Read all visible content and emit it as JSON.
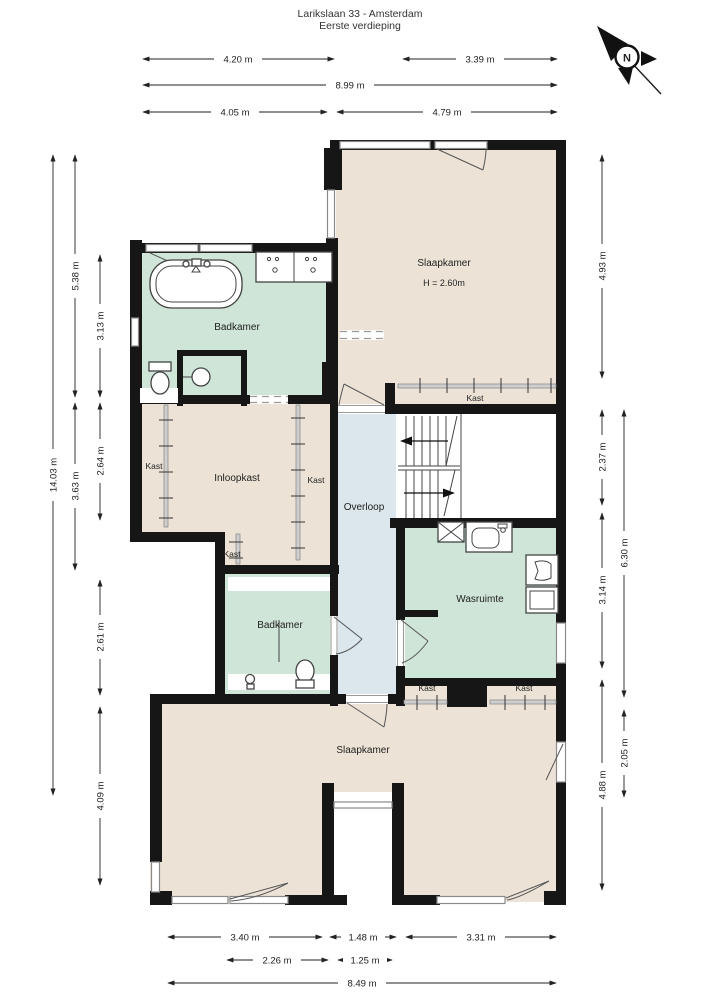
{
  "title": {
    "line1": "Larikslaan 33 - Amsterdam",
    "line2": "Eerste verdieping"
  },
  "compass": {
    "label": "N"
  },
  "rooms": {
    "badkamer_top": {
      "label": "Badkamer"
    },
    "slaapkamer_top": {
      "label": "Slaapkamer",
      "ceiling": "H = 2.60m"
    },
    "kast_slaapkamer": {
      "label": "Kast"
    },
    "kast_left": {
      "label": "Kast"
    },
    "inloopkast": {
      "label": "Inloopkast"
    },
    "kast_mid": {
      "label": "Kast"
    },
    "kast_small": {
      "label": "Kast"
    },
    "overloop": {
      "label": "Overloop"
    },
    "wasruimte": {
      "label": "Wasruimte"
    },
    "badkamer_bottom": {
      "label": "Badkamer"
    },
    "kast_bottom_left": {
      "label": "Kast"
    },
    "kast_bottom_right": {
      "label": "Kast"
    },
    "slaapkamer_bottom": {
      "label": "Slaapkamer"
    }
  },
  "dimensions": {
    "top": {
      "d1": "4.20 m",
      "d2": "3.39 m",
      "d3": "8.99 m",
      "d4": "4.05 m",
      "d5": "4.79 m"
    },
    "left": {
      "d1": "14.03 m",
      "d2": "5.38 m",
      "d3": "3.63 m",
      "d4": "3.13 m",
      "d5": "2.64 m",
      "d6": "2.61 m",
      "d7": "4.09 m"
    },
    "right": {
      "d1": "4.93 m",
      "d2": "2.37 m",
      "d3": "3.14 m",
      "d4": "4.88 m",
      "d5": "6.30 m",
      "d6": "2.05 m"
    },
    "bottom": {
      "d1": "3.40 m",
      "d2": "1.48 m",
      "d3": "3.31 m",
      "d4": "2.26 m",
      "d5": "1.25 m",
      "d6": "8.49 m"
    }
  },
  "colors": {
    "room_beige": "#ece3d6",
    "room_green": "#cfe5d8",
    "room_blue": "#dbe7ed",
    "wall": "#161616",
    "window": "#8a8a8a"
  }
}
